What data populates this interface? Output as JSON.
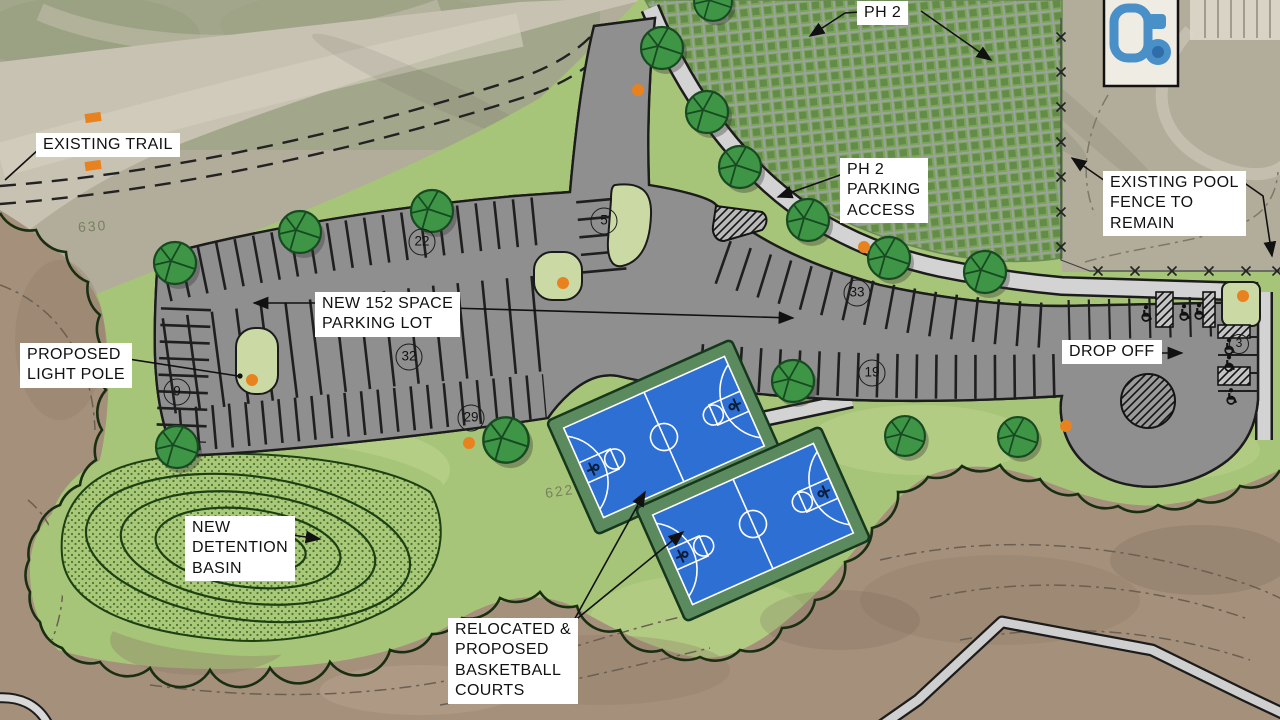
{
  "plan": {
    "title": "Park improvements site plan",
    "labels": {
      "existing_trail": "EXISTING  TRAIL",
      "ph2": "PH 2",
      "ph2_parking_access": [
        "PH 2",
        "PARKING",
        "ACCESS"
      ],
      "pool_fence": [
        "EXISTING POOL",
        "FENCE TO",
        "REMAIN"
      ],
      "new_parking": [
        "NEW 152 SPACE",
        "PARKING LOT"
      ],
      "light_pole": [
        "PROPOSED",
        "LIGHT POLE"
      ],
      "drop_off": "DROP OFF",
      "detention": [
        "NEW",
        "DETENTION",
        "BASIN"
      ],
      "courts": [
        "RELOCATED &",
        "PROPOSED",
        "BASKETBALL",
        "COURTS"
      ]
    },
    "stall_counts": [
      "22",
      "5",
      "33",
      "32",
      "19",
      "9",
      "29",
      "3"
    ],
    "contours": [
      "630",
      "622"
    ],
    "icons": {
      "tree": "tree-icon",
      "light_pole": "light-pole-icon",
      "accessible": "accessible-parking-icon",
      "fence_x": "fence-x-icon",
      "pool": "pool-icon"
    },
    "colors": {
      "asphalt": "#8f8f8f",
      "lawn": "#a7c579",
      "island": "#cbdaa4",
      "court_blue": "#2e6fd4",
      "court_border": "#5b8a5e",
      "tree": "#3f9546",
      "light_pole": "#e8821e",
      "road": "#c8c2b2",
      "woods": "#a5907b",
      "detention": "#a9c878",
      "walk": "#d3d3d3"
    }
  }
}
